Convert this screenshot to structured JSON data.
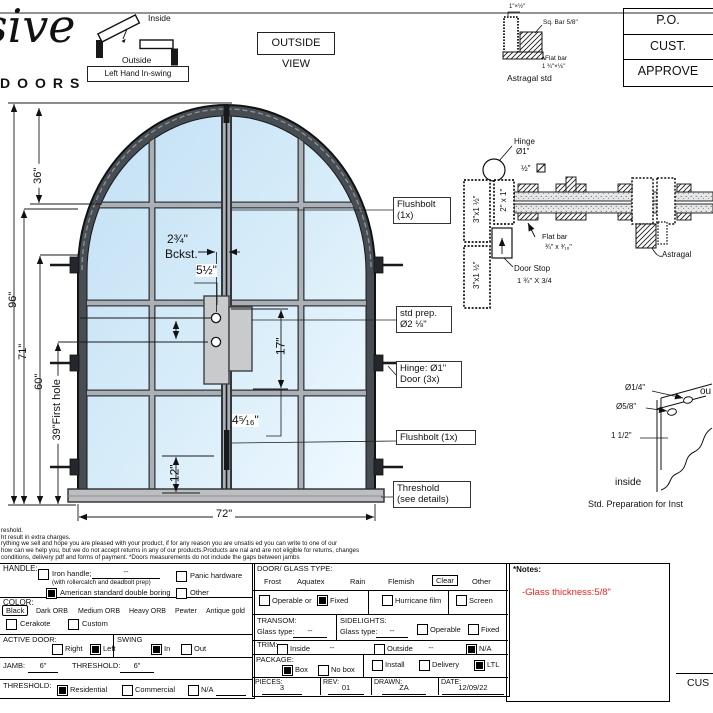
{
  "sheet": {
    "logo_script": "sive",
    "logo_word": "DOORS",
    "swing_diagram": {
      "inside": "Inside",
      "outside": "Outside",
      "handing": "Left Hand In-swing"
    },
    "view_label": "OUTSIDE VIEW",
    "approval_rows": [
      "P.O.",
      "CUST.",
      "APPROVE"
    ],
    "astragal_std": {
      "top_dim": "1\"×½\"",
      "sq_bar": "Sq. Bar 5/8\"",
      "flat_bar": "Flat bar",
      "flat_bar_dim": "1 ¾\"×⅛\"",
      "caption": "Astragal std"
    }
  },
  "door": {
    "dim_96": "96\"",
    "dim_71": "71\"",
    "dim_60": "60\"",
    "dim_39": "39\"First hole",
    "dim_36": "36\"",
    "dim_72": "72\"",
    "backset_val": "2¾\"",
    "backset_word": "Bckst.",
    "dim_5half": "5½\"",
    "dim_17": "17\"",
    "dim_4_5_16": "4⁵⁄₁₆\"",
    "dim_12": "12\"",
    "callout_flushbolt_top_1": "Flushbolt",
    "callout_flushbolt_top_2": "(1x)",
    "callout_stdprep_1": "std prep.",
    "callout_stdprep_2": "Ø2 ⅛\"",
    "callout_hinge_1": "Hinge: Ø1\"",
    "callout_hinge_2": "Door (3x)",
    "callout_flushbolt_bottom": "Flushbolt (1x)",
    "callout_threshold_1": "Threshold",
    "callout_threshold_2": "(see details)"
  },
  "jamb_section": {
    "hinge_1": "Hinge",
    "hinge_2": "Ø1\"",
    "profile_a": "3\"x1 ½\"",
    "profile_b": "3\"x1 ½\"",
    "profile_c": "2\" x 1\"",
    "half_bar": "½\"",
    "flat_bar_1": "Flat bar",
    "flat_bar_2": "¾\" x ³⁄₁₆\"",
    "door_stop_1": "Door Stop",
    "door_stop_2": "1 ¾\" X 3/4",
    "astragal": "Astragal"
  },
  "prep_detail": {
    "hole_small": "Ø1/4\"",
    "hole_big": "Ø5/8\"",
    "offset": "1 1/2\"",
    "inside": "inside",
    "outside_partial": "ou",
    "caption": "Std. Preparation for Inst"
  },
  "fine_print": [
    "reshold.",
    "ht result in extra charges.",
    "rything we sell and hope you are pleased with your product, if for any reason you are unsatis ed you can write to one of our",
    " how can we help you, but we do not accept returns in any of our products.Products are  nal and are not eligible for returns, changes",
    "conditions, delivery pdf and forms of payment. *Doors measurements do not include the gaps between jambs"
  ],
  "order_form": {
    "handle": {
      "label": "HANDLE:",
      "iron_handle": "Iron handle;",
      "iron_handle_dash": "--",
      "iron_note": "(with rollercatch and deadbolt prep)",
      "american": "American standard double boring",
      "panic": "Panic hardware",
      "other": "Other"
    },
    "color": {
      "label": "COLOR:",
      "opts": [
        "Black",
        "Dark ORB",
        "Medium ORB",
        "Heavy ORB",
        "Pewter",
        "Antique gold"
      ],
      "cerakote": "Cerakote",
      "custom": "Custom"
    },
    "active_door": {
      "label": "ACTIVE DOOR:",
      "right": "Right",
      "left": "Left"
    },
    "swing": {
      "label": "SWING",
      "in": "In",
      "out": "Out"
    },
    "jamb_row": {
      "jamb_label": "JAMB:",
      "jamb_value": "6\"",
      "threshold_label": "THRESHOLD:",
      "threshold_value": "6\""
    },
    "threshold_row": {
      "label": "THRESHOLD:",
      "residential": "Residential",
      "commercial": "Commercial",
      "na": "N/A"
    },
    "glass": {
      "label": "DOOR/ GLASS TYPE:",
      "opts": [
        "Frost",
        "Aquatex",
        "Rain",
        "Flemish",
        "Clear",
        "Other"
      ]
    },
    "fixing": {
      "operable": "Operable or",
      "fixed": "Fixed",
      "hurricane": "Hurricane film",
      "screen": "Screen"
    },
    "transom": {
      "label": "TRANSOM:",
      "glass_type": "Glass type:",
      "value": "--"
    },
    "sidelights": {
      "label": "SIDELIGHTS:",
      "glass_type": "Glass type:",
      "value": "--",
      "operable": "Operable",
      "fixed": "Fixed"
    },
    "trim": {
      "label": "TRIM:",
      "inside": "Inside",
      "inside_val": "--",
      "outside": "Outside",
      "outside_val": "--",
      "na": "N/A"
    },
    "package": {
      "label": "PACKAGE:",
      "box": "Box",
      "no_box": "No box",
      "install": "Install",
      "delivery": "Delivery",
      "ltl": "LTL"
    },
    "meta": {
      "pieces_label": "PIECES:",
      "pieces": "3",
      "rev_label": "REV:",
      "rev": "01",
      "drawn_label": "DRAWN:",
      "drawn": "ZA",
      "date_label": "DATE:",
      "date": "12/09/22"
    },
    "notes": {
      "label": "*Notes:",
      "note": "-Glass thickness:5/8\""
    },
    "signature": "CUS"
  },
  "colors": {
    "glass_top": "#c2e0f5",
    "glass_bottom": "#f0f9ff",
    "frame": "#474d53",
    "muntin": "#aab0b5",
    "note_red": "#e8251f"
  }
}
